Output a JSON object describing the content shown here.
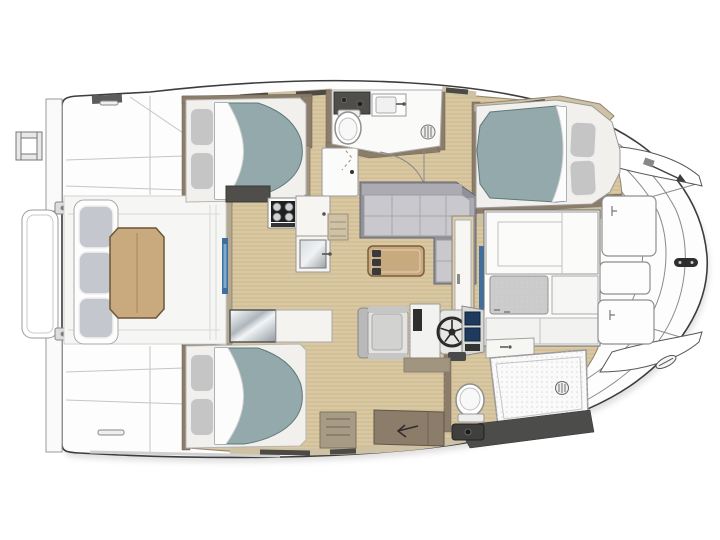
{
  "image": {
    "kind": "yacht-floor-plan-top-view",
    "width": 720,
    "height": 540,
    "background": "#ffffff"
  },
  "colors": {
    "hull_fill": "#fdfdfd",
    "hull_outline": "#3d3d3d",
    "deck_seam": "#c8c8c8",
    "floor_wood": "#d9c8a1",
    "wall_dark": "#8b7d6a",
    "wall_mid": "#a2957f",
    "wall_light": "#cfc2a4",
    "window_frame": "#4b4a45",
    "mattress": "#93a9ab",
    "mattress_edge": "#5f7878",
    "sheet_white": "#fcfcfc",
    "pillow_gray": "#c5c5c5",
    "bed_base": "#f1f0ec",
    "sofa_back": "#90909a",
    "sofa_backrest": "#ababb1",
    "sofa_cushion": "#c8c8cd",
    "bench_cushion": "#c4c7cd",
    "table_wood": "#c9aa7e",
    "table_edge": "#6e5536",
    "chair_light": "#e3e3e1",
    "screen_blue": "#1e3a5e",
    "wheel_dark": "#2b2b2b",
    "accent_blue": "#3e6f9e",
    "accent_blue_light": "#7fa8cc",
    "stove_dark": "#1f1f1f",
    "counter_dark": "#4f4e4a",
    "steel_light": "#d8dcdf",
    "steel_dark": "#9aa1a7",
    "band_dark": "#4c4c4a",
    "taupe_step": "#a89b85",
    "fixture_stroke": "#8f8f8f"
  },
  "areas": [
    "swim-platform",
    "transom-steps",
    "aft-cockpit",
    "cockpit-bench",
    "cockpit-table",
    "port-guest-cabin",
    "starboard-guest-cabin",
    "galley",
    "forward-head",
    "salon-sofa",
    "coffee-table",
    "wardrobe",
    "berth-cabin",
    "forward-cabin",
    "helm-station",
    "aft-head",
    "companionway",
    "bow-deck",
    "deck-hatches"
  ],
  "fixtures": {
    "beds": 3,
    "toilets": 2,
    "showers": 2,
    "sinks": 2,
    "stove_burners": 4,
    "steering_wheels": 1,
    "nav_screens": 2,
    "deck_hatches": 3,
    "remotes_on_table": 3,
    "bench_cushions": 3,
    "pillows": 6
  }
}
